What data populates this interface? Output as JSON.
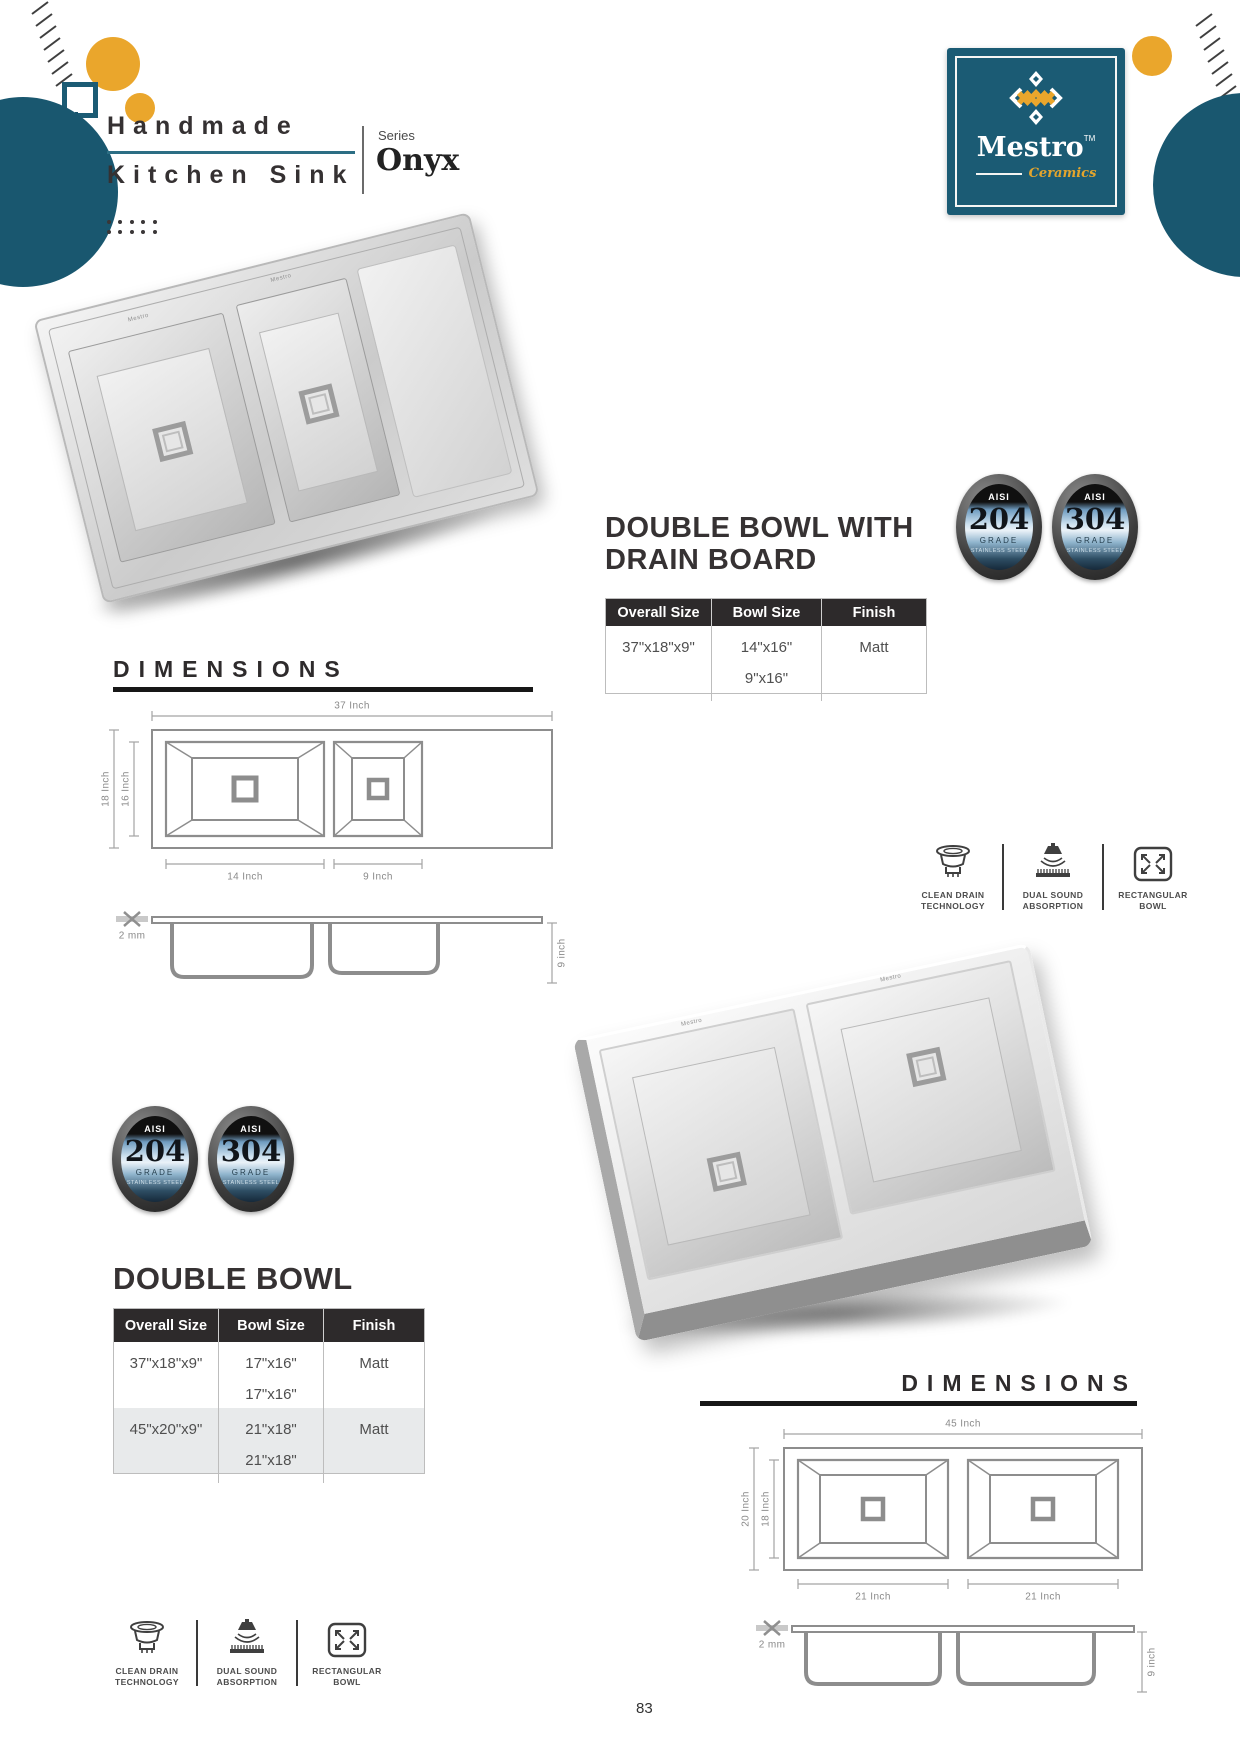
{
  "colors": {
    "teal": "#1b5b74",
    "gold": "#eaa62c",
    "heading": "#363233",
    "table_header_bg": "#2d2a2b"
  },
  "header": {
    "title_line1": "Handmade",
    "title_line2": "Kitchen Sink",
    "series_label": "Series",
    "series_name": "Onyx"
  },
  "brand": {
    "name": "Mestro",
    "tm": "TM",
    "tagline": "Ceramics"
  },
  "badges": {
    "aisi": "AISI",
    "grade_word": "GRADE",
    "material": "STAINLESS STEEL",
    "items": [
      {
        "grade": "204"
      },
      {
        "grade": "304"
      }
    ]
  },
  "features": [
    {
      "line1": "CLEAN DRAIN",
      "line2": "TECHNOLOGY"
    },
    {
      "line1": "DUAL SOUND",
      "line2": "ABSORPTION"
    },
    {
      "line1": "RECTANGULAR",
      "line2": "BOWL"
    }
  ],
  "product1": {
    "title_line1": "DOUBLE BOWL WITH",
    "title_line2": "DRAIN BOARD",
    "dimensions_title": "DIMENSIONS",
    "table": {
      "headers": [
        "Overall Size",
        "Bowl Size",
        "Finish"
      ],
      "rows": [
        {
          "overall": "37\"x18\"x9\"",
          "bowl_sizes": [
            "14\"x16\"",
            "9\"x16\""
          ],
          "finish": "Matt"
        }
      ]
    },
    "drawing": {
      "overall_width": "37 Inch",
      "outer_depth": "18 Inch",
      "inner_depth": "16 Inch",
      "bowl1_width": "14 Inch",
      "bowl2_width": "9 Inch",
      "thickness": "2 mm",
      "bowl_height": "9 inch"
    }
  },
  "product2": {
    "title": "DOUBLE BOWL",
    "dimensions_title": "DIMENSIONS",
    "table": {
      "headers": [
        "Overall Size",
        "Bowl Size",
        "Finish"
      ],
      "rows": [
        {
          "overall": "37\"x18\"x9\"",
          "bowl_sizes": [
            "17\"x16\"",
            "17\"x16\""
          ],
          "finish": "Matt"
        },
        {
          "overall": "45\"x20\"x9\"",
          "bowl_sizes": [
            "21\"x18\"",
            "21\"x18\""
          ],
          "finish": "Matt"
        }
      ]
    },
    "drawing": {
      "overall_width": "45 Inch",
      "outer_depth": "20 Inch",
      "inner_depth": "18 Inch",
      "bowl1_width": "21 Inch",
      "bowl2_width": "21 Inch",
      "thickness": "2 mm",
      "bowl_height": "9 inch"
    }
  },
  "page_number": "83"
}
